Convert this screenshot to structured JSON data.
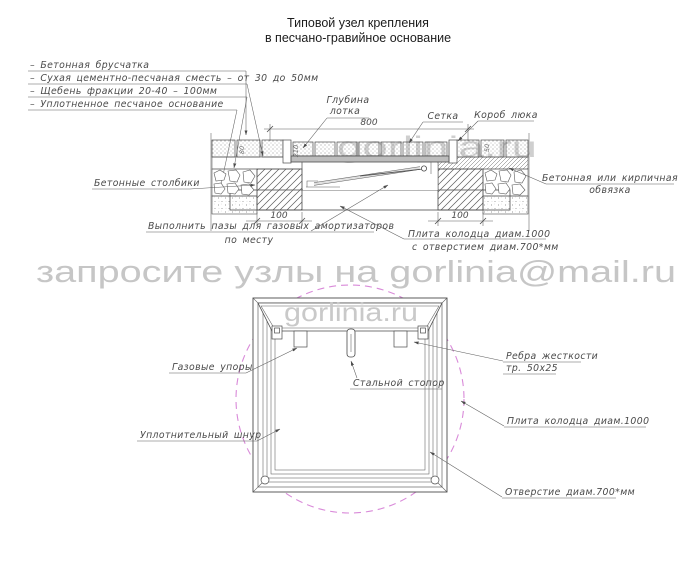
{
  "title": {
    "line1": "Типовой узел крепления",
    "line2": "в песчано-гравийное основание"
  },
  "legend": {
    "items": [
      "–  Бетонная брусчатка",
      "–  Сухая цементно-песчаная сместь – от 30 до 50мм",
      "–  Щебень фракции 20-40 – 100мм",
      "–  Уплотненное песчаное основание"
    ]
  },
  "section": {
    "labels": {
      "tray_depth_1": "Глубина",
      "tray_depth_2": "лотка",
      "mesh": "Сетка",
      "hatch_box": "Короб люка",
      "posts": "Бетонные столбики",
      "strapping_1": "Бетонная или кирпичная",
      "strapping_2": "обвязка",
      "grooves_1": "Выполнить пазы для газовых амортизаторов",
      "grooves_2": "по месту",
      "plate_1": "Плита колодца диам.1000",
      "plate_2": "с отверстием диам.700*мм"
    },
    "dims": {
      "opening_width": "800",
      "post_left": "100",
      "post_right": "100",
      "paving_height": "80",
      "tray_depth": "210",
      "layer_height": "50"
    }
  },
  "plan": {
    "labels": {
      "gas_struts": "Газовые упоры",
      "steel_stopper": "Стальной стопор",
      "ribs_1": "Ребра жесткости",
      "ribs_2": "тр. 50х25",
      "sealing_cord": "Уплотнительный шнур",
      "plate": "Плита колодца диам.1000",
      "hole": "Отверстие диам.700*мм"
    }
  },
  "watermark": {
    "request": "запросите узлы на gorlinia@mail.ru",
    "site": "gorlinia.ru",
    "site_over_section": "gorlinia.ru"
  },
  "colors": {
    "line": "#4b4b4b",
    "label_text": "#4a4a4a",
    "magenta_dashed": "#d98ad9",
    "watermark_gray": "#c6c6c6"
  }
}
